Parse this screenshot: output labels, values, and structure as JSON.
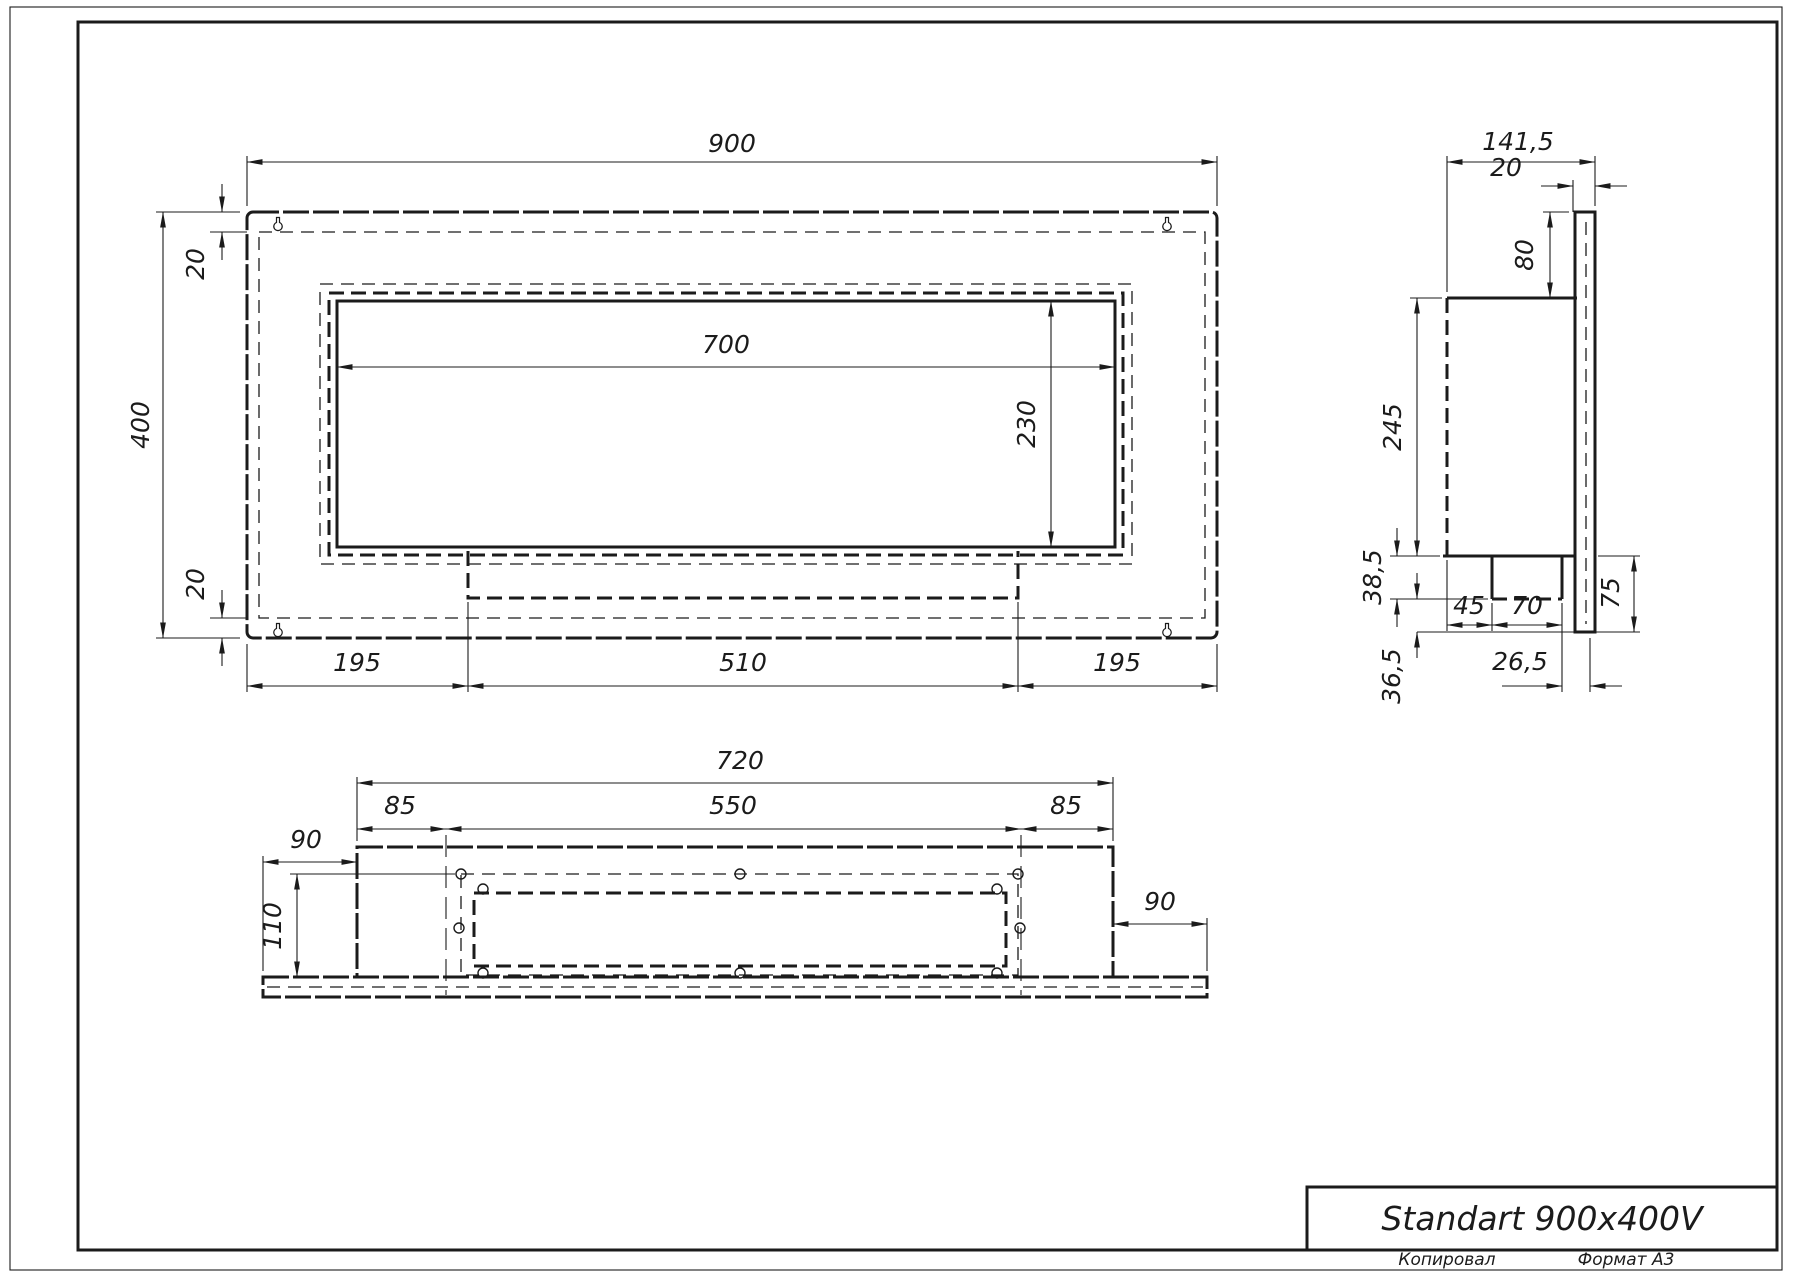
{
  "title_block": {
    "title": "Standart 900x400V",
    "copied_by": "Копировал",
    "format": "Формат А3"
  },
  "front_view": {
    "width": "900",
    "height": "400",
    "opening_width": "700",
    "opening_height": "230",
    "top_inset": "20",
    "bottom_inset": "20",
    "bottom_left_margin": "195",
    "burner_width": "510",
    "bottom_right_margin": "195"
  },
  "side_view": {
    "total_depth": "141,5",
    "back_plate_thickness": "20",
    "plate_above_body": "80",
    "body_height": "245",
    "burner_drop": "38,5",
    "below_burner": "36,5",
    "front_to_burner": "45",
    "burner_depth": "70",
    "plate_below_body": "75",
    "burner_to_back": "26,5"
  },
  "bottom_view": {
    "body_width": "720",
    "left_inset": "85",
    "burner_width": "550",
    "right_inset": "85",
    "plate_left_overhang": "90",
    "plate_right_overhang": "90",
    "body_depth": "110"
  }
}
